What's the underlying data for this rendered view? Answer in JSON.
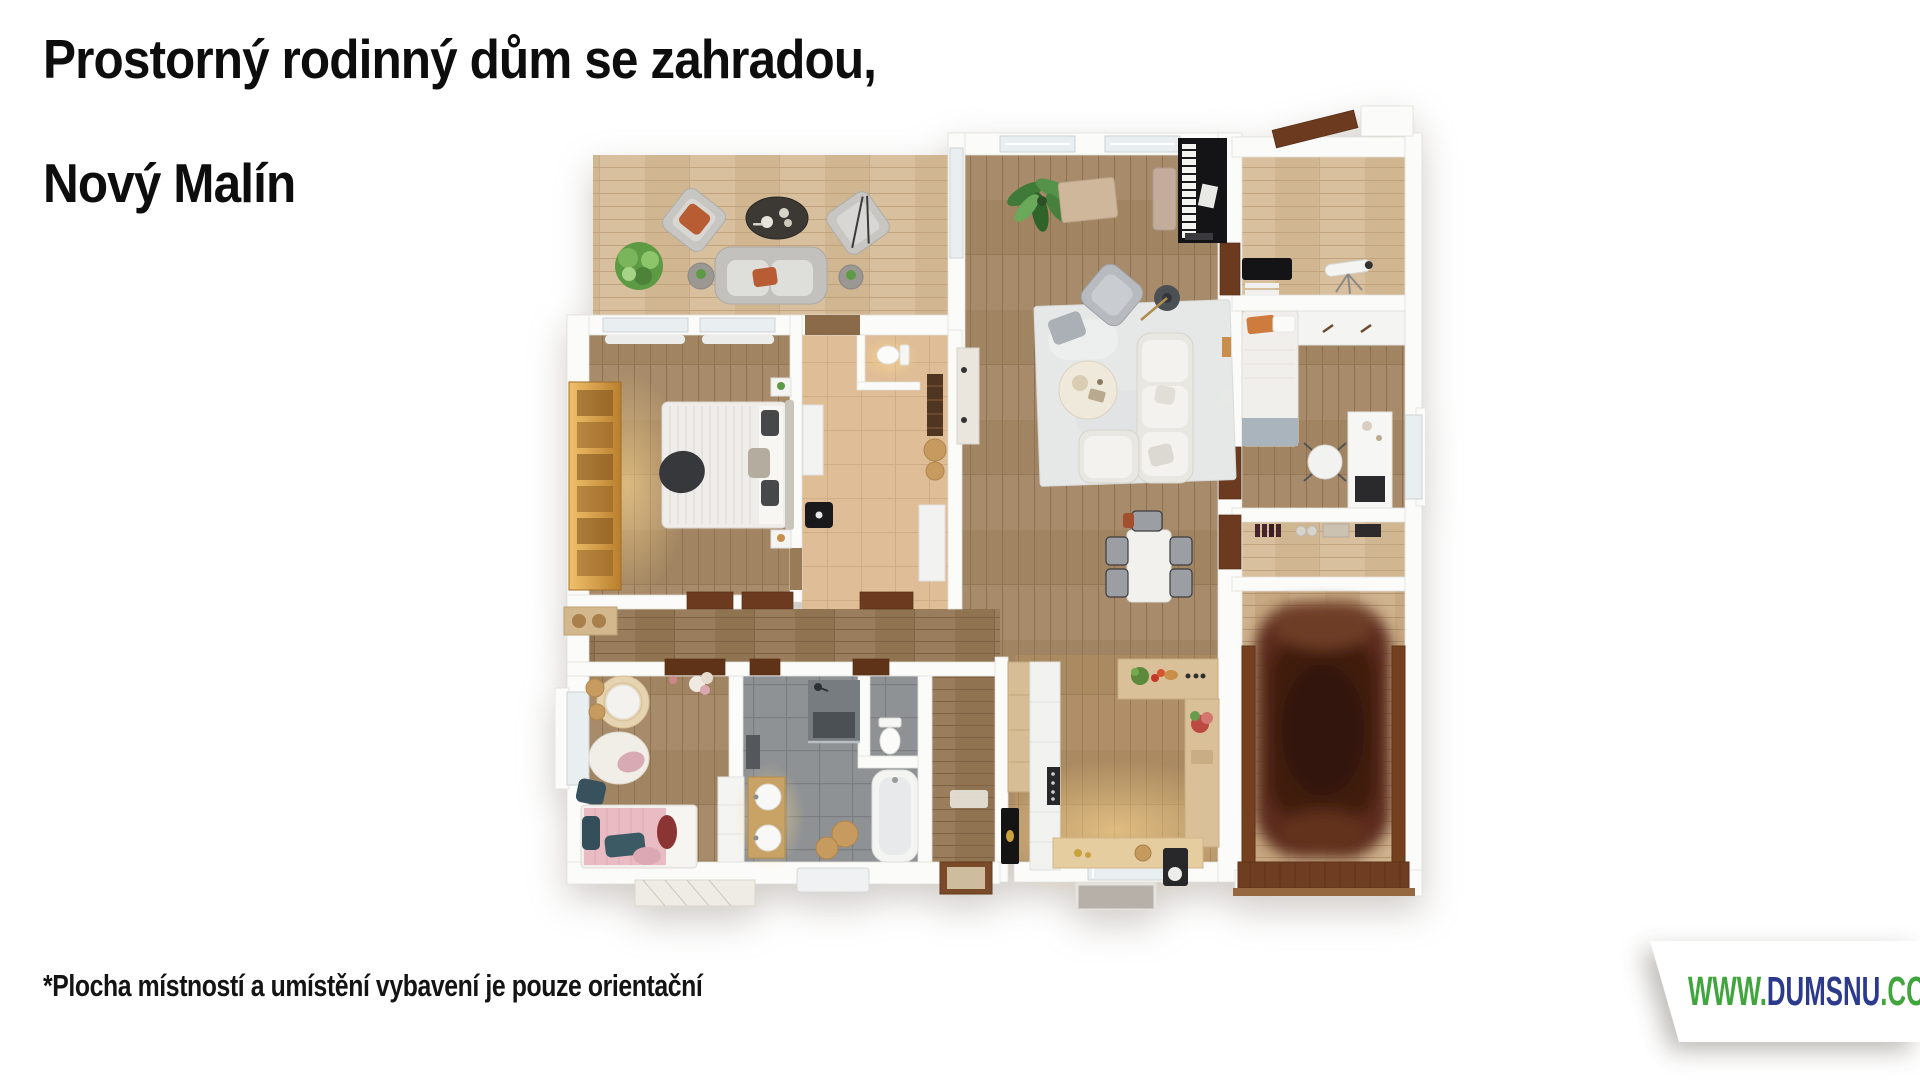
{
  "header": {
    "title_line1": "Prostorný rodinný dům se zahradou,",
    "title_line2": "Nový Malín"
  },
  "footer": {
    "disclaimer": "*Plocha místností a umístění vybavení je pouze orientační"
  },
  "watermark": {
    "www": "WWW.",
    "brand": "DUMSNU",
    "tld": ".COM",
    "color_green": "#3fa53c",
    "color_navy": "#2b3a8c",
    "background": "#ffffff"
  },
  "floorplan": {
    "kind": "3D top-down architectural render of a single-storey family house",
    "rooms": [
      {
        "id": "terrace",
        "label": "terrace lounge"
      },
      {
        "id": "living-room",
        "label": "living room with piano"
      },
      {
        "id": "dining-area",
        "label": "dining area"
      },
      {
        "id": "kitchen",
        "label": "U-shaped kitchen"
      },
      {
        "id": "master-bedroom",
        "label": "master bedroom"
      },
      {
        "id": "foyer",
        "label": "inner hall with guest WC"
      },
      {
        "id": "hallway",
        "label": "hallway"
      },
      {
        "id": "kids-bedroom",
        "label": "children's bedroom"
      },
      {
        "id": "bathroom",
        "label": "bathroom with tub and shower"
      },
      {
        "id": "entry-hall",
        "label": "entrance hall"
      },
      {
        "id": "study",
        "label": "study with telescope"
      },
      {
        "id": "bedroom-2",
        "label": "bedroom with desk"
      },
      {
        "id": "pantry",
        "label": "pantry shelf"
      },
      {
        "id": "garage",
        "label": "garage with car"
      }
    ],
    "palette": {
      "walls": "#fbfbfa",
      "wood_light": "#d8bf9d",
      "wood_medium": "#a78b6a",
      "wood_dark": "#9a7d5c",
      "tile_gray": "#8e9294",
      "tile_tan": "#debd97",
      "car_brown": "#45200f",
      "door_brown": "#6b3a1f"
    }
  }
}
